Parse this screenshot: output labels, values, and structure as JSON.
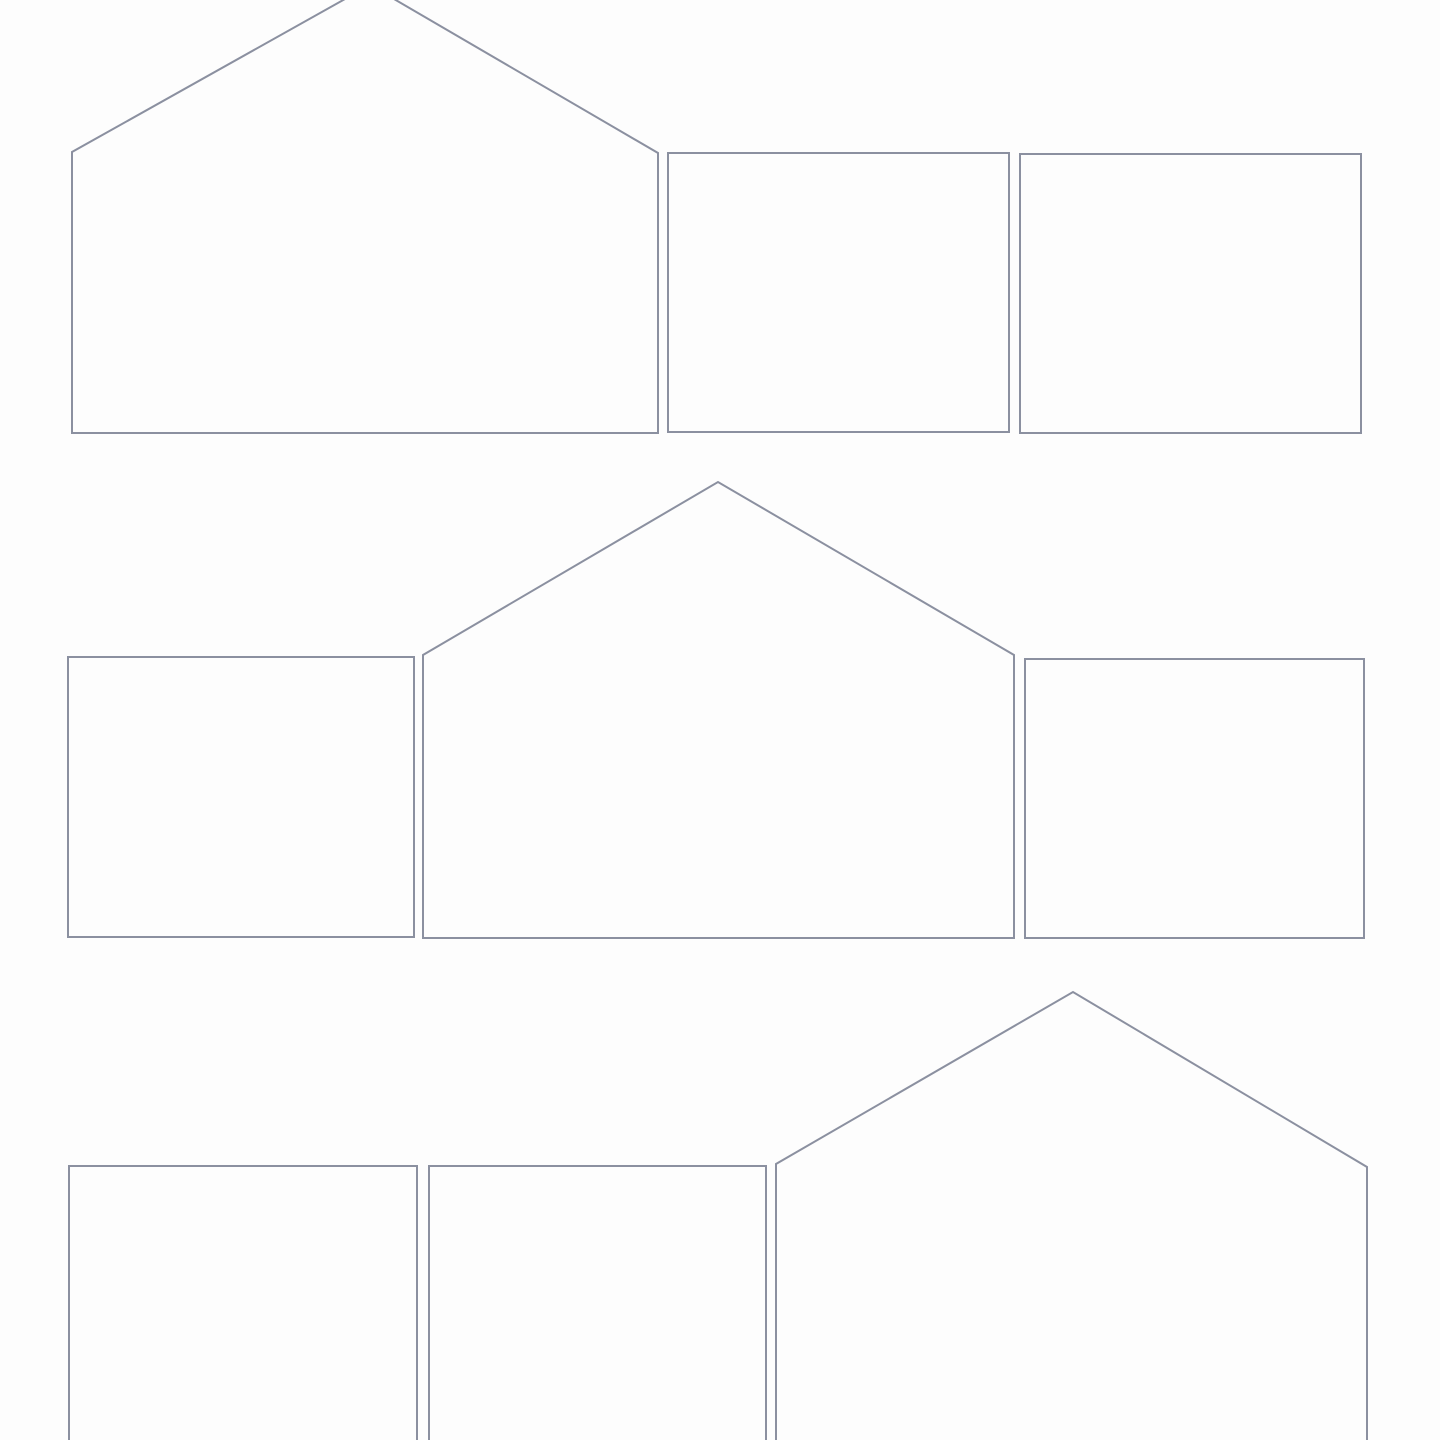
{
  "page": {
    "description": "Blank cut-out template sheet: three rows of outlined shapes (house-shaped pentagons and rectangles), no text or fill"
  },
  "canvas": {
    "width": 1440,
    "height": 1440,
    "background": "#fdfdfd",
    "stroke_color": "#8b90a0",
    "stroke_width": 2,
    "shapes": [
      {
        "name": "house-outline-row1",
        "kind": "house-pentagon",
        "row": 1,
        "points": [
          [
            72,
            433
          ],
          [
            72,
            152
          ],
          [
            370,
            -15
          ],
          [
            658,
            153
          ],
          [
            658,
            433
          ]
        ]
      },
      {
        "name": "rect-outline-row1-middle",
        "kind": "rectangle",
        "row": 1,
        "points": [
          [
            668,
            432
          ],
          [
            668,
            153
          ],
          [
            1009,
            153
          ],
          [
            1009,
            432
          ]
        ]
      },
      {
        "name": "rect-outline-row1-right",
        "kind": "rectangle",
        "row": 1,
        "points": [
          [
            1020,
            433
          ],
          [
            1020,
            154
          ],
          [
            1361,
            154
          ],
          [
            1361,
            433
          ]
        ]
      },
      {
        "name": "rect-outline-row2-left",
        "kind": "rectangle",
        "row": 2,
        "points": [
          [
            68,
            937
          ],
          [
            68,
            657
          ],
          [
            414,
            657
          ],
          [
            414,
            937
          ]
        ]
      },
      {
        "name": "house-outline-row2",
        "kind": "house-pentagon",
        "row": 2,
        "points": [
          [
            423,
            938
          ],
          [
            423,
            655
          ],
          [
            718,
            482
          ],
          [
            1014,
            655
          ],
          [
            1014,
            938
          ]
        ]
      },
      {
        "name": "rect-outline-row2-right",
        "kind": "rectangle",
        "row": 2,
        "points": [
          [
            1025,
            938
          ],
          [
            1025,
            659
          ],
          [
            1364,
            659
          ],
          [
            1364,
            938
          ]
        ]
      },
      {
        "name": "rect-outline-row3-left",
        "kind": "rectangle",
        "row": 3,
        "points": [
          [
            69,
            1470
          ],
          [
            69,
            1166
          ],
          [
            417,
            1166
          ],
          [
            417,
            1470
          ]
        ]
      },
      {
        "name": "rect-outline-row3-middle",
        "kind": "rectangle",
        "row": 3,
        "points": [
          [
            429,
            1470
          ],
          [
            429,
            1166
          ],
          [
            766,
            1166
          ],
          [
            766,
            1470
          ]
        ]
      },
      {
        "name": "house-outline-row3",
        "kind": "house-pentagon",
        "row": 3,
        "points": [
          [
            776,
            1470
          ],
          [
            776,
            1164
          ],
          [
            1073,
            992
          ],
          [
            1367,
            1167
          ],
          [
            1367,
            1470
          ]
        ]
      }
    ]
  }
}
